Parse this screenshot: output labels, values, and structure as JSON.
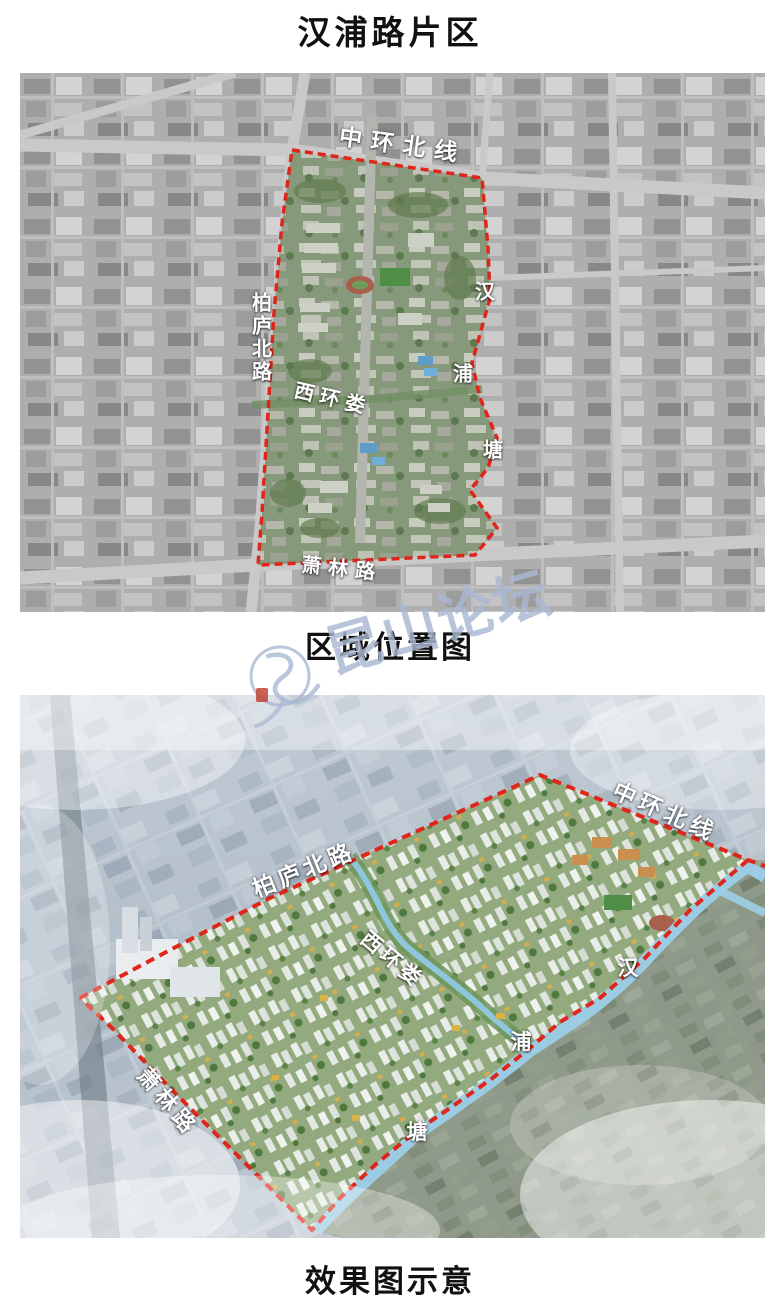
{
  "page": {
    "title": "汉浦路片区"
  },
  "location_map": {
    "caption": "区域位置图",
    "boundary_color": "#e0251b",
    "labels": {
      "north_road": "中环北线",
      "west_road": "柏庐北路",
      "center_waterway": "西环娄",
      "east_stream_char_1": "汉",
      "east_stream_char_2": "浦",
      "east_stream_char_3": "塘",
      "south_road": "萧林路"
    }
  },
  "render_map": {
    "caption": "效果图示意",
    "boundary_color": "#e0251b",
    "canal_color": "#9ccfe8",
    "labels": {
      "north_road": "中环北线",
      "west_road": "柏庐北路",
      "center_waterway": "西环娄",
      "east_stream_char_1": "汉",
      "east_stream_char_2": "浦",
      "east_stream_char_3": "塘",
      "south_road": "萧林路"
    }
  },
  "watermark": {
    "text": "昆山论坛",
    "color": "#a9b8d2",
    "seal_color": "#c0453a"
  }
}
